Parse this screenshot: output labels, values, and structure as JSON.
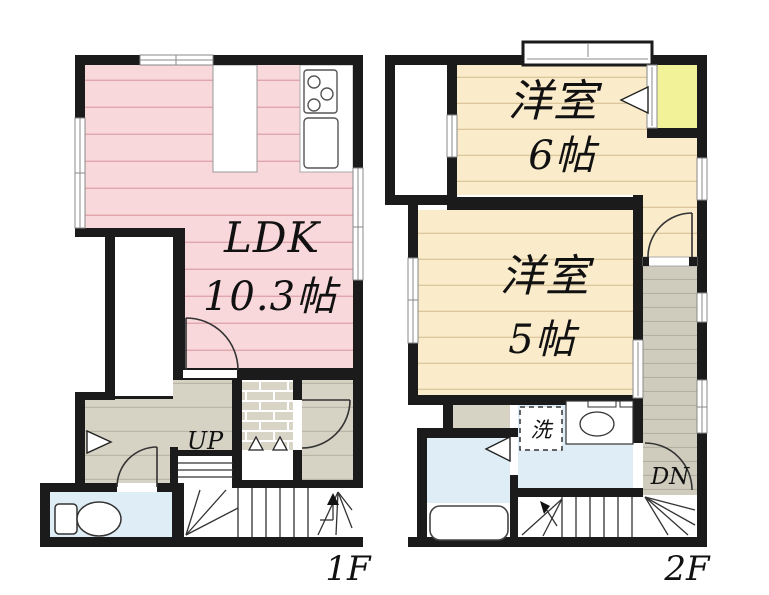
{
  "floor1": {
    "floor_label": "1F",
    "ldk": {
      "name": "LDK",
      "area": "10.3帖"
    },
    "stairs_label": "UP"
  },
  "floor2": {
    "floor_label": "2F",
    "bedroom_6": {
      "name": "洋室",
      "area": "6帖"
    },
    "bedroom_5": {
      "name": "洋室",
      "area": "5帖"
    },
    "stairs_label": "DN",
    "washing_machine_label": "洗"
  },
  "colors": {
    "wall": "#1b1b1b",
    "ldk_floor_pink": "#f8d8da",
    "bedroom_floor_cream": "#faeccb",
    "closet_yellow": "#f2f298",
    "wet_area_blue": "#dfeef6",
    "hallway_beige": "#d6d2c4",
    "corridor_gray": "#cfccbe",
    "genkan_tile": "#d8d4c6"
  }
}
